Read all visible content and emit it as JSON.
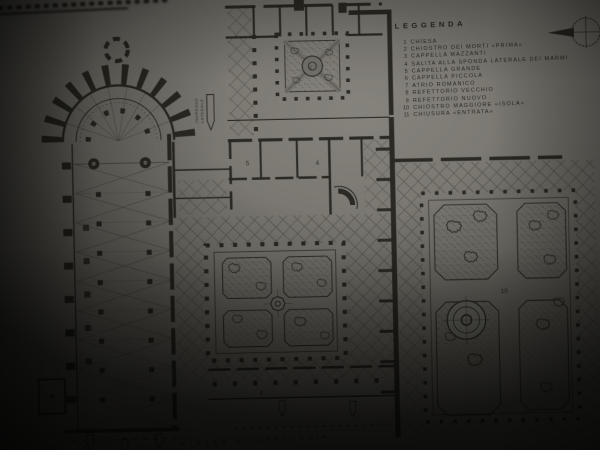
{
  "legend": {
    "title": "LEGGENDA",
    "items": [
      {
        "num": "1",
        "label": "CHIESA"
      },
      {
        "num": "2",
        "label": "CHIOSTRO DEI MORTI «PRIMA»"
      },
      {
        "num": "3",
        "label": "CAPPELLA MAZZANTI"
      },
      {
        "num": "4",
        "label": "SALITA ALLA SPONDA LATERALE DEI MARMI"
      },
      {
        "num": "5",
        "label": "CAPPELLA GRANDE"
      },
      {
        "num": "6",
        "label": "CAPPELLA PICCOLA"
      },
      {
        "num": "7",
        "label": "ATRIO ROMANICO"
      },
      {
        "num": "8",
        "label": "REFETTORIO VECCHIO"
      },
      {
        "num": "9",
        "label": "REFETTORIO NUOVO"
      },
      {
        "num": "10",
        "label": "CHIOSTRO MAGGIORE «ISOLA»"
      },
      {
        "num": "11",
        "label": "CHIUSURA «ENTRATA»"
      }
    ]
  },
  "plan": {
    "numbers": [
      {
        "value": "2"
      },
      {
        "value": "4"
      },
      {
        "value": "5"
      },
      {
        "value": "8"
      },
      {
        "value": "10"
      }
    ],
    "entrance_note": {
      "line1": "INGRESSO",
      "line2": "LATERALE"
    },
    "caption_bottom": "PIAZZA S. ANASTASIA"
  },
  "icons": {
    "compass": "north-arrow",
    "fountain": "cloister-fountain",
    "gate_arrow": "entrance-arrow"
  },
  "colors": {
    "paper": "#7b7972",
    "ink": "#1c1b15"
  }
}
